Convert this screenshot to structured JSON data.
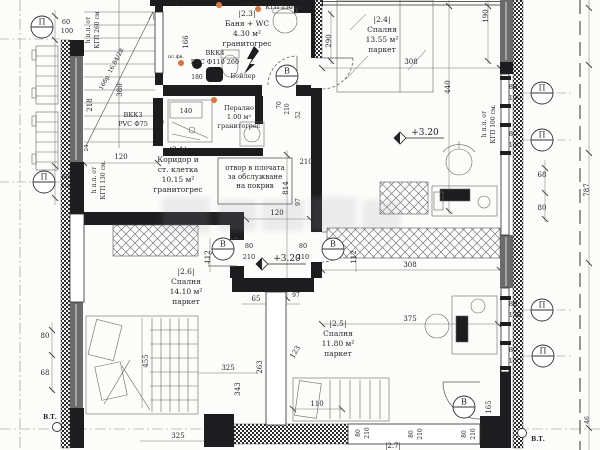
{
  "meta": {
    "drawing_type": "floor plan",
    "language": "bg",
    "ink": "#26262a",
    "accent_orange": "#e0733a",
    "glazing_gray": "#6b6b6b"
  },
  "rooms": [
    {
      "id": "|2.1|",
      "lines": [
        "Коридор и",
        "ст. клетка"
      ],
      "area": "10.15 м²",
      "floor": "гранитогрес",
      "x": 178,
      "y": 152
    },
    {
      "id": "|2.3|",
      "lines": [
        "Баня + WC"
      ],
      "area": "4.30 м²",
      "floor": "гранитогрес",
      "x": 247,
      "y": 16
    },
    {
      "id": "|2.4|",
      "lines": [
        "Спалня"
      ],
      "area": "13.55 м²",
      "floor": "паркет",
      "x": 382,
      "y": 22
    },
    {
      "id": "|2.5|",
      "lines": [
        "Спалня"
      ],
      "area": "11.80 м²",
      "floor": "паркет",
      "x": 338,
      "y": 326
    },
    {
      "id": "|2.6|",
      "lines": [
        "Спалня"
      ],
      "area": "14.10 м²",
      "floor": "паркет",
      "x": 186,
      "y": 274
    }
  ],
  "annotations": [
    {
      "name": "roof-opening-note",
      "lines": [
        "отвор в плочата",
        "за обслужване",
        "на покрив"
      ],
      "x": 255,
      "y": 170,
      "fs": 7
    },
    {
      "name": "vkk4-riser",
      "lines": [
        "ВКК4",
        "PVC Ф110 260"
      ],
      "x": 215,
      "y": 55,
      "fs": 6.5
    },
    {
      "name": "vkk3-riser",
      "lines": [
        "ВКК3",
        "PVC Ф75"
      ],
      "x": 133,
      "y": 117,
      "fs": 6.5
    },
    {
      "name": "laundry",
      "lines": [
        "Перално",
        "1.00 м²",
        "гранитогрес"
      ],
      "x": 239,
      "y": 110,
      "fs": 6.5
    }
  ],
  "labels": [
    {
      "t": "164",
      "x": 172,
      "y": 5
    },
    {
      "t": "КГП 130 см",
      "x": 284,
      "y": 9,
      "fs": 6
    },
    {
      "t": "пс.фв.",
      "x": 176,
      "y": 58,
      "fs": 5
    },
    {
      "t": "пс.фв.",
      "x": 252,
      "y": 5,
      "fs": 5
    },
    {
      "t": "60",
      "x": 66,
      "y": 24,
      "fs": 6.5
    },
    {
      "t": "100",
      "x": 67,
      "y": 33,
      "fs": 6.5
    },
    {
      "t": "60",
      "x": 66,
      "y": 179,
      "fs": 6.5
    },
    {
      "t": "100",
      "x": 67,
      "y": 188,
      "fs": 6.5
    },
    {
      "t": "120",
      "x": 121,
      "y": 159
    },
    {
      "t": "120",
      "x": 277,
      "y": 215
    },
    {
      "t": "210",
      "x": 306,
      "y": 164
    },
    {
      "t": "140",
      "x": 186,
      "y": 113,
      "fs": 6.5
    },
    {
      "t": "180",
      "x": 197,
      "y": 79,
      "fs": 6
    },
    {
      "t": "Бойлер",
      "x": 243,
      "y": 78,
      "fs": 6.5
    },
    {
      "t": "80",
      "x": 249,
      "y": 248,
      "fs": 6.5
    },
    {
      "t": "210",
      "x": 249,
      "y": 259,
      "fs": 6.5
    },
    {
      "t": "80",
      "x": 303,
      "y": 248,
      "fs": 6.5
    },
    {
      "t": "210",
      "x": 303,
      "y": 259,
      "fs": 6.5
    },
    {
      "t": "65",
      "x": 256,
      "y": 301
    },
    {
      "t": "97",
      "x": 296,
      "y": 297,
      "fs": 6
    },
    {
      "t": "325",
      "x": 228,
      "y": 370
    },
    {
      "t": "325",
      "x": 178,
      "y": 438
    },
    {
      "t": "110",
      "x": 317,
      "y": 406
    },
    {
      "t": "375",
      "x": 410,
      "y": 321
    },
    {
      "t": "308",
      "x": 411,
      "y": 64
    },
    {
      "t": "308",
      "x": 410,
      "y": 267
    },
    {
      "t": "68",
      "x": 542,
      "y": 177
    },
    {
      "t": "80",
      "x": 542,
      "y": 210
    },
    {
      "t": "80",
      "x": 45,
      "y": 338
    },
    {
      "t": "68",
      "x": 45,
      "y": 375
    },
    {
      "t": "80",
      "x": 513,
      "y": 89,
      "fs": 6.5
    },
    {
      "t": "130",
      "x": 515,
      "y": 100,
      "fs": 6.5
    },
    {
      "t": "80",
      "x": 513,
      "y": 136,
      "fs": 6.5
    },
    {
      "t": "130",
      "x": 515,
      "y": 147,
      "fs": 6.5
    },
    {
      "t": "80",
      "x": 513,
      "y": 306,
      "fs": 6.5
    },
    {
      "t": "130",
      "x": 515,
      "y": 317,
      "fs": 6.5
    },
    {
      "t": "80",
      "x": 513,
      "y": 352,
      "fs": 6.5
    },
    {
      "t": "130",
      "x": 515,
      "y": 363,
      "fs": 6.5
    },
    {
      "t": "|2.7|",
      "x": 393,
      "y": 448,
      "fs": 7
    },
    {
      "t": "166",
      "x": 188,
      "y": 42,
      "r": -90
    },
    {
      "t": "380",
      "x": 122,
      "y": 90,
      "r": -90
    },
    {
      "t": "218",
      "x": 92,
      "y": 105,
      "r": -90
    },
    {
      "t": "24",
      "x": 88,
      "y": 148,
      "r": -90,
      "fs": 5.5
    },
    {
      "t": "190",
      "x": 488,
      "y": 16,
      "r": -90
    },
    {
      "t": "290",
      "x": 331,
      "y": 41,
      "r": -90
    },
    {
      "t": "440",
      "x": 450,
      "y": 87,
      "r": -90
    },
    {
      "t": "787",
      "x": 589,
      "y": 190,
      "r": -90
    },
    {
      "t": "814",
      "x": 288,
      "y": 188,
      "r": -90
    },
    {
      "t": "112",
      "x": 210,
      "y": 257,
      "r": -90
    },
    {
      "t": "112",
      "x": 356,
      "y": 257,
      "r": -90
    },
    {
      "t": "70",
      "x": 281,
      "y": 105,
      "r": -90,
      "fs": 6
    },
    {
      "t": "210",
      "x": 289,
      "y": 109,
      "r": -90,
      "fs": 6
    },
    {
      "t": "52",
      "x": 300,
      "y": 115,
      "r": -90,
      "fs": 6
    },
    {
      "t": "97",
      "x": 300,
      "y": 202,
      "r": -90,
      "fs": 6
    },
    {
      "t": "263",
      "x": 262,
      "y": 367,
      "r": -90
    },
    {
      "t": "343",
      "x": 240,
      "y": 389,
      "r": -90
    },
    {
      "t": "455",
      "x": 148,
      "y": 361,
      "r": -90
    },
    {
      "t": "123",
      "x": 297,
      "y": 353,
      "r": -60
    },
    {
      "t": "165",
      "x": 491,
      "y": 407,
      "r": -90
    },
    {
      "t": "46",
      "x": 589,
      "y": 420,
      "r": -90,
      "fs": 6
    },
    {
      "t": "80",
      "x": 360,
      "y": 433,
      "r": -90,
      "fs": 6
    },
    {
      "t": "210",
      "x": 369,
      "y": 433,
      "r": -90,
      "fs": 6
    },
    {
      "t": "80",
      "x": 413,
      "y": 434,
      "r": -90,
      "fs": 6
    },
    {
      "t": "210",
      "x": 422,
      "y": 434,
      "r": -90,
      "fs": 6
    },
    {
      "t": "80",
      "x": 466,
      "y": 434,
      "r": -90,
      "fs": 6
    },
    {
      "t": "210",
      "x": 475,
      "y": 434,
      "r": -90,
      "fs": 6
    },
    {
      "t": "16бр. 16,84/28",
      "x": 113,
      "y": 70,
      "r": -62,
      "fs": 6
    },
    {
      "t": "h п.п. от",
      "x": 90,
      "y": 30,
      "r": -90,
      "fs": 6
    },
    {
      "t": "КГП 260 см",
      "x": 99,
      "y": 30,
      "r": -90,
      "fs": 6
    },
    {
      "t": "h п.п. от",
      "x": 96,
      "y": 180,
      "r": -90,
      "fs": 6
    },
    {
      "t": "КГП 130 см.",
      "x": 105,
      "y": 180,
      "r": -90,
      "fs": 6
    },
    {
      "t": "h п.п. от",
      "x": 486,
      "y": 124,
      "r": -90,
      "fs": 6
    },
    {
      "t": "КГП 100 см.",
      "x": 495,
      "y": 124,
      "r": -90,
      "fs": 6
    }
  ],
  "markers": [
    {
      "t": "П",
      "x": 42,
      "y": 27
    },
    {
      "t": "П",
      "x": 44,
      "y": 182
    },
    {
      "t": "П",
      "x": 542,
      "y": 93
    },
    {
      "t": "П",
      "x": 542,
      "y": 140
    },
    {
      "t": "П",
      "x": 542,
      "y": 310
    },
    {
      "t": "П",
      "x": 543,
      "y": 356
    },
    {
      "t": "В",
      "x": 287,
      "y": 76
    },
    {
      "t": "В",
      "x": 223,
      "y": 249
    },
    {
      "t": "В",
      "x": 333,
      "y": 249
    },
    {
      "t": "В",
      "x": 464,
      "y": 407
    }
  ],
  "level_markers": [
    {
      "t": "+3.20",
      "x": 400,
      "y": 138
    },
    {
      "t": "+3.20",
      "x": 262,
      "y": 264
    }
  ],
  "bt_markers": [
    {
      "t": "В.Т.",
      "cx": 57,
      "cy": 427,
      "tx": 50,
      "ty": 419
    },
    {
      "t": "В.Т.",
      "cx": 522,
      "cy": 433,
      "tx": 538,
      "ty": 441
    }
  ],
  "dots": [
    {
      "x": 181,
      "y": 63
    },
    {
      "x": 219,
      "y": 5
    },
    {
      "x": 214,
      "y": 100
    },
    {
      "x": 258,
      "y": 9
    }
  ]
}
